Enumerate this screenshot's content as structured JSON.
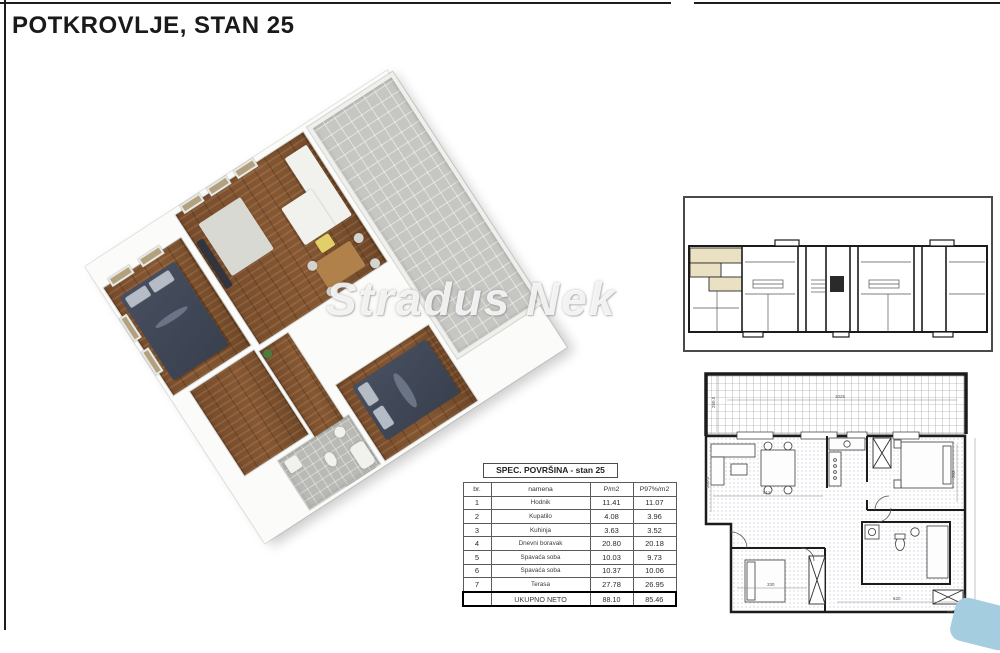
{
  "header": {
    "title": "POTKROVLJE, STAN 25"
  },
  "watermark": {
    "text": "Stradus Nek"
  },
  "spec_table": {
    "title": "SPEC. POVRŠINA  - stan 25",
    "columns": {
      "num": "br.",
      "name": "namena",
      "area": "P/m2",
      "area97": "P97%/m2"
    },
    "rows": [
      {
        "num": "1",
        "name": "Hodnik",
        "area": "11.41",
        "area97": "11.07"
      },
      {
        "num": "2",
        "name": "Kupatilo",
        "area": "4.08",
        "area97": "3.96"
      },
      {
        "num": "3",
        "name": "Kuhinja",
        "area": "3.63",
        "area97": "3.52"
      },
      {
        "num": "4",
        "name": "Dnevni boravak",
        "area": "20.80",
        "area97": "20.18"
      },
      {
        "num": "5",
        "name": "Spavaća soba",
        "area": "10.03",
        "area97": "9.73"
      },
      {
        "num": "6",
        "name": "Spavaća soba",
        "area": "10.37",
        "area97": "10.06"
      },
      {
        "num": "7",
        "name": "Terasa",
        "area": "27.78",
        "area97": "26.95"
      }
    ],
    "total": {
      "label": "UKUPNO NETO",
      "area": "88.10",
      "area97": "85.46"
    }
  },
  "detail_plan": {
    "dims": {
      "d1": "260.5",
      "d2": "1025",
      "d3": "300.5",
      "d4": "512",
      "d5": "302",
      "d6": "330",
      "d7": "620"
    }
  },
  "colors": {
    "highlight_unit": "#eae0c2",
    "wood_floor": "#7d512e",
    "terrace_gray": "#c2c2bf",
    "bed_navy": "#3e4657",
    "window_beige": "#b2a17e",
    "corner_blue": "#a5cde0"
  }
}
